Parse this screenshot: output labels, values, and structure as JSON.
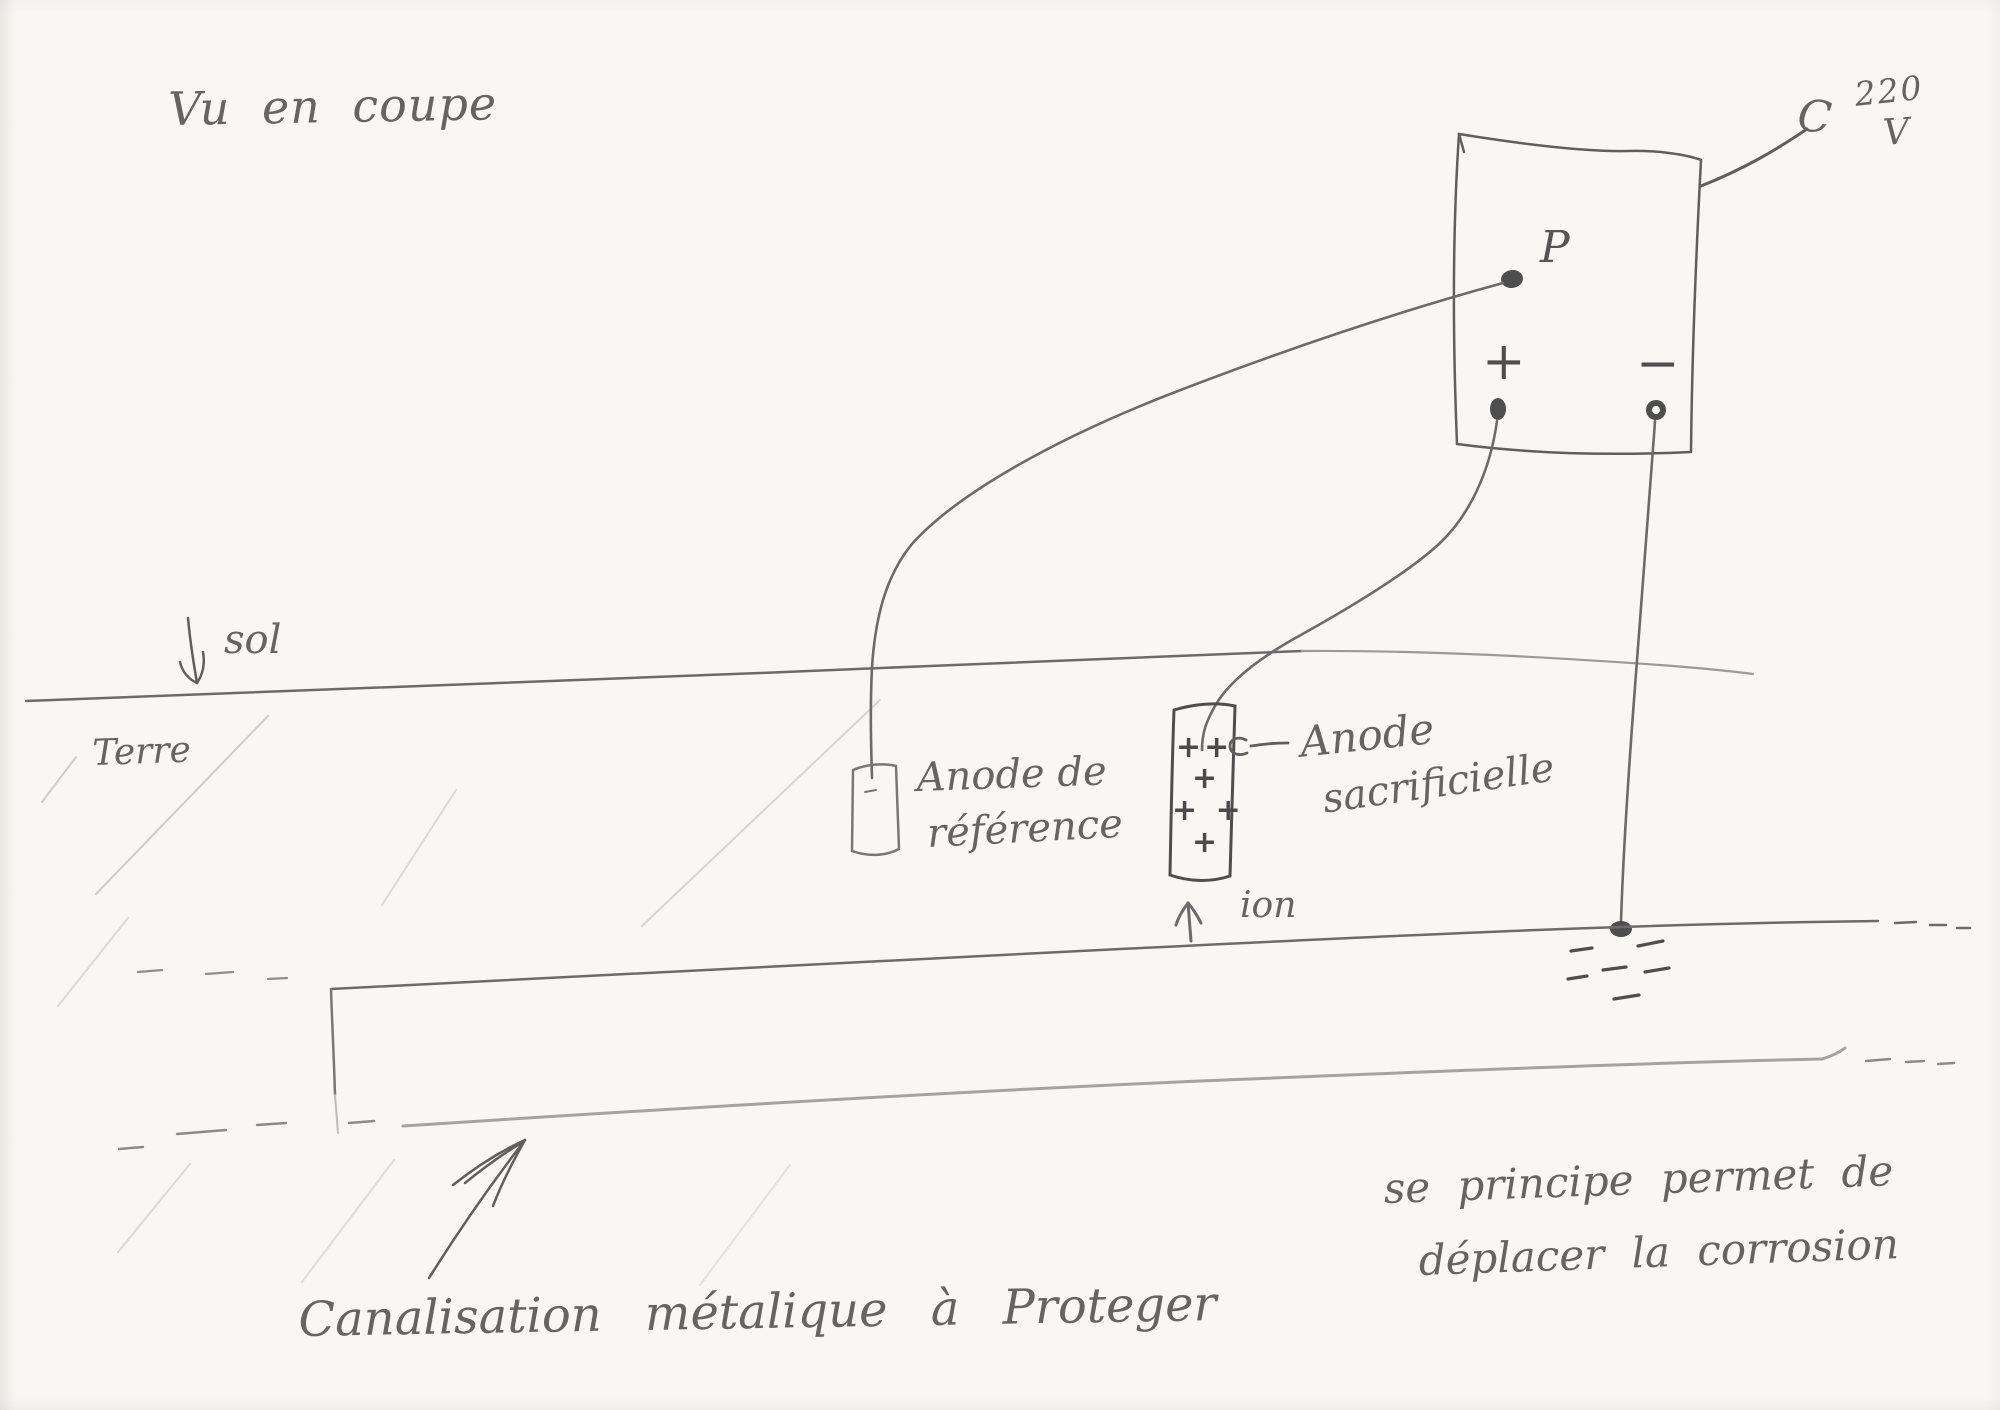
{
  "diagram": {
    "title": "Vu en coupe",
    "power_supply": {
      "prefix": "C",
      "voltage": "220",
      "unit": "V",
      "terminal_p": "P",
      "terminal_plus": "+",
      "terminal_minus": "−"
    },
    "soil": {
      "surface": "sol",
      "earth": "Terre"
    },
    "reference_anode": {
      "line1": "Anode de",
      "line2": "référence"
    },
    "sacrificial_anode": {
      "line1": "Anode",
      "line2": "sacrificielle",
      "charges": [
        "++",
        "+",
        "+ +",
        "+"
      ],
      "ion": "ion"
    },
    "pipeline": {
      "caption": "Canalisation métalique à Proteger"
    },
    "note": {
      "line1": "se principe permet de",
      "line2": "déplacer la corrosion"
    },
    "colors": {
      "ink": "#6b6b6b",
      "dark_ink": "#4e4e4e",
      "light_pencil": "#a3a3a3",
      "hatch": "#cccccc",
      "paper": "#f8f7f3"
    }
  }
}
